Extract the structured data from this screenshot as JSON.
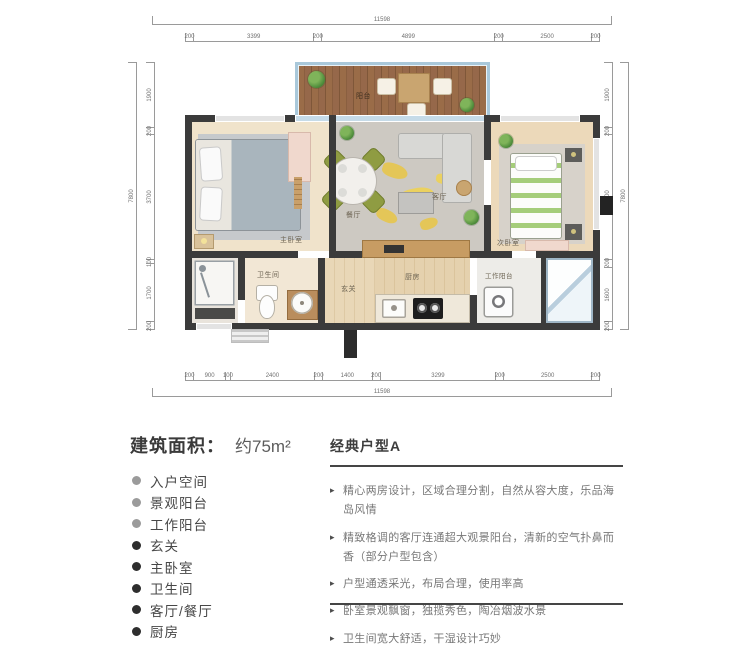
{
  "plan": {
    "dims": {
      "top": {
        "total": "11598",
        "segments": [
          "200",
          "3399",
          "200",
          "4899",
          "200",
          "2500",
          "200"
        ]
      },
      "bottom": {
        "total": "11598",
        "segments": [
          "200",
          "900",
          "100",
          "2400",
          "200",
          "1400",
          "200",
          "3299",
          "200",
          "2500",
          "200"
        ]
      },
      "left": {
        "total": "7800",
        "segments": [
          "1900",
          "200",
          "3700",
          "100",
          "1700",
          "200"
        ]
      },
      "right": {
        "total": "7800",
        "segments": [
          "1900",
          "200",
          "3700",
          "200",
          "1600",
          "200"
        ]
      }
    },
    "rooms": {
      "balcony": "阳台",
      "master": "主卧室",
      "dining": "餐厅",
      "living": "客厅",
      "second": "次卧室",
      "bath": "卫生间",
      "hall": "玄关",
      "kitchen": "厨房",
      "work_balcony": "工作阳台"
    }
  },
  "info": {
    "area_label": "建筑面积：",
    "area_value": "约75m²",
    "rooms": [
      {
        "label": "入户空间"
      },
      {
        "label": "景观阳台"
      },
      {
        "label": "工作阳台"
      },
      {
        "label": "玄关"
      },
      {
        "label": "主卧室"
      },
      {
        "label": "卫生间"
      },
      {
        "label": "客厅/餐厅"
      },
      {
        "label": "厨房"
      }
    ]
  },
  "type_card": {
    "heading": "经典户型A",
    "bullets": [
      "精心两房设计，区域合理分割，自然从容大度，乐品海岛风情",
      "精致格调的客厅连通超大观景阳台，清新的空气扑鼻而香（部分户型包含）",
      "户型通透采光，布局合理，使用率高",
      "卧室景观飘窗，独揽秀色，陶冶烟波水景",
      "卫生间宽大舒适，干湿设计巧妙"
    ]
  },
  "colors": {
    "wall": "#3b3b3b",
    "deck_wood": "#96684a",
    "balcony_frame": "#a9c8da",
    "chair_olive": "#8f9c42",
    "rug_gray": "#cdc9c2",
    "accent_yellow": "#e8c545",
    "furniture_pink": "#f0d8cd"
  }
}
